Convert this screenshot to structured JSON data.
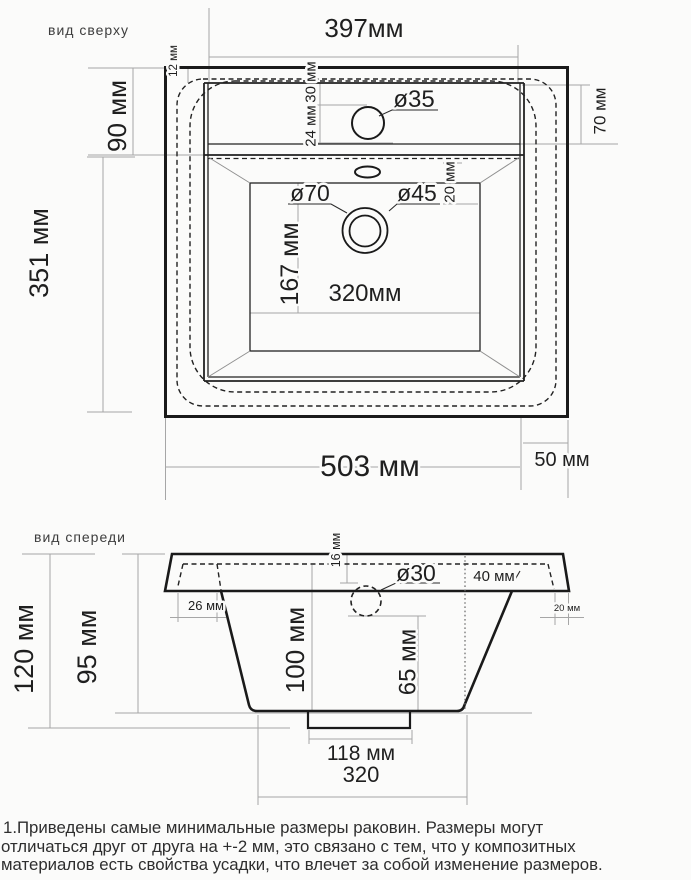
{
  "colors": {
    "background": "#fbfbfa",
    "line": "#1a1a1a",
    "dim_line": "#a6a6a6",
    "text": "#1f1f1f"
  },
  "top_view": {
    "title": "вид сверху",
    "deck_width": "397мм",
    "deck_depth": "90 мм",
    "body_depth": "351 мм",
    "edge_gap": "12 мм",
    "faucet_back_offset": "30 мм",
    "faucet_center_offset": "24 мм",
    "faucet_hole_dia": "ø35",
    "right_back_depth": "70 мм",
    "drain_recess_dia": "ø70",
    "drain_hole_dia": "ø45",
    "overflow_gap": "20 мм",
    "basin_depth": "167 мм",
    "basin_width": "320мм",
    "overall_width": "503 мм",
    "side_ledge": "50 мм"
  },
  "front_view": {
    "title": "вид спереди",
    "overall_height": "120 мм",
    "bowl_height": "95 мм",
    "rim_inset": "26 мм",
    "deck_thickness": "16 мм",
    "faucet_hole_dia": "ø30",
    "back_offset": "40 мм",
    "edge_ledge": "20 мм",
    "inner_depth": "100 мм",
    "drain_depth": "65 мм",
    "flange_width": "118 мм",
    "bottom_width": "320"
  },
  "footnote": {
    "line1": "1.Приведены самые минимальные размеры раковин. Размеры могут",
    "line2": "отличаться друг от друга на +-2 мм, это связано с тем, что у композитных",
    "line3": "материалов есть свойства усадки, что влечет за собой изменение размеров."
  }
}
